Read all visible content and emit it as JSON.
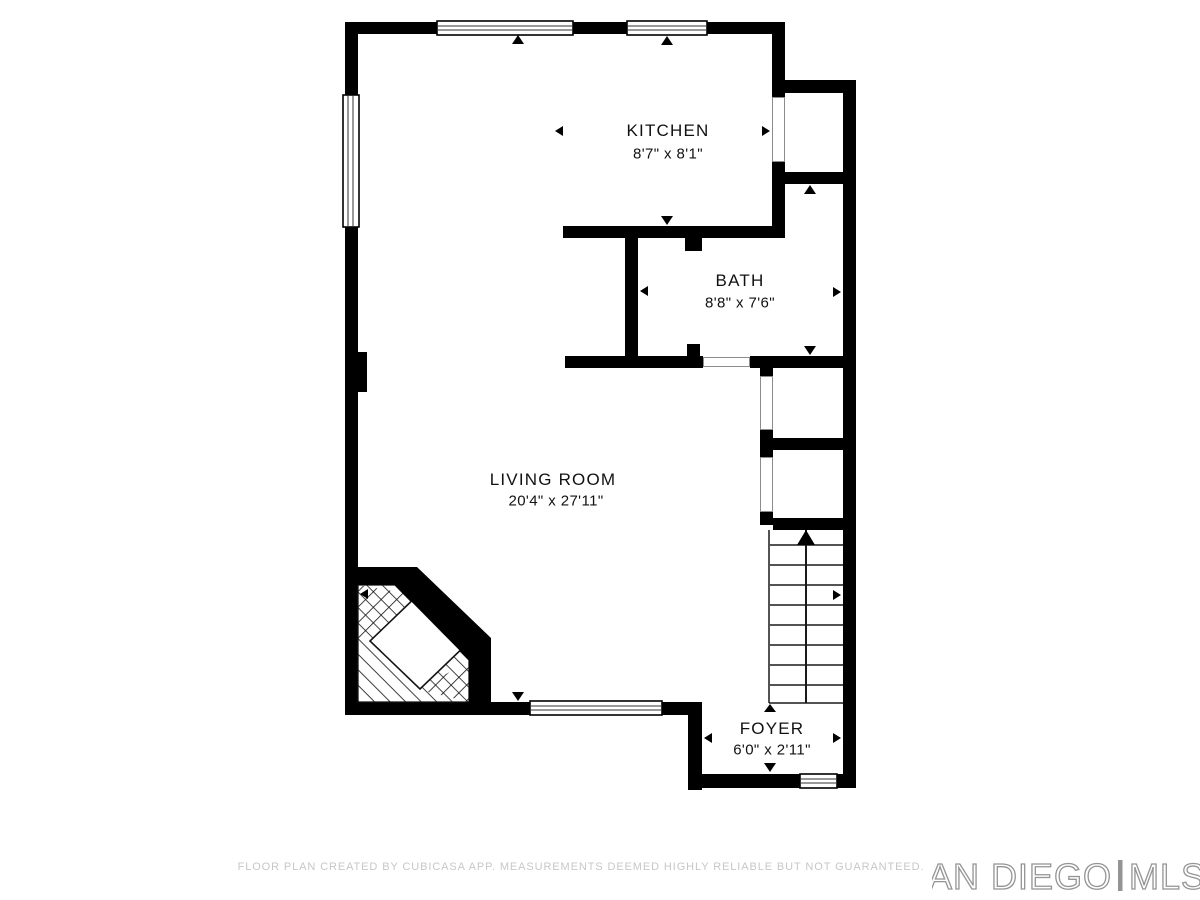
{
  "rooms": {
    "kitchen": {
      "name": "KITCHEN",
      "dimensions": "8'7\" x 8'1\""
    },
    "bath": {
      "name": "BATH",
      "dimensions": "8'8\" x 7'6\""
    },
    "living_room": {
      "name": "LIVING ROOM",
      "dimensions": "20'4\" x 27'11\""
    },
    "foyer": {
      "name": "FOYER",
      "dimensions": "6'0\" x 2'11\""
    }
  },
  "footer": {
    "disclaimer": "FLOOR PLAN CREATED BY CUBICASA APP. MEASUREMENTS DEEMED HIGHLY RELIABLE BUT NOT GUARANTEED."
  },
  "logo": {
    "primary": "SAN DIEGO",
    "secondary": "MLS"
  },
  "colors": {
    "wall": "#000000",
    "background": "#ffffff",
    "footer_text": "#c7c7c7",
    "logo_outline": "#949494"
  }
}
